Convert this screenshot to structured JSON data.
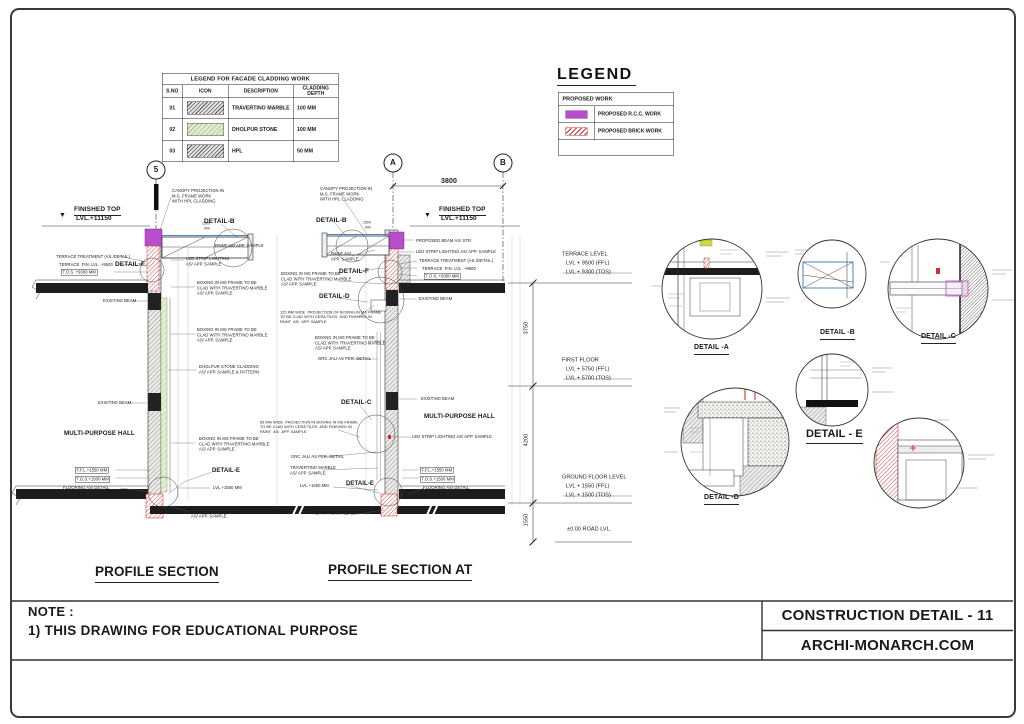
{
  "title_block": {
    "title": "CONSTRUCTION DETAIL - 11",
    "website": "ARCHI-MONARCH.COM"
  },
  "note": {
    "label": "NOTE :",
    "line1": "1) THIS DRAWING FOR EDUCATIONAL PURPOSE"
  },
  "cladding_legend": {
    "title": "LEGEND FOR FACADE CLADDING  WORK",
    "headers": [
      "S.NO",
      "ICON",
      "DESCRIPTION",
      "CLADDING DEPTH"
    ],
    "rows": [
      {
        "sno": "01",
        "icon": "travertino-hatch",
        "description": "TRAVERTINO MARBLE",
        "depth": "100 MM"
      },
      {
        "sno": "02",
        "icon": "dholpur-hatch",
        "description": "DHOLPUR STONE",
        "depth": "100 MM"
      },
      {
        "sno": "03",
        "icon": "hpl-hatch",
        "description": "HPL",
        "depth": "50 MM"
      }
    ]
  },
  "work_legend": {
    "title": "LEGEND",
    "header": "PROPOSED WORK",
    "items": [
      {
        "type": "rcc",
        "label": "PROPOSED R.C.C. WORK"
      },
      {
        "type": "brick",
        "label": "PROPOSED BRICK WORK"
      }
    ]
  },
  "colors": {
    "rcc_purple": "#b84ecb",
    "brick_red": "#cc3333",
    "canopy_blue": "#4a86c2",
    "dholpur_green": "#e1ecd1"
  },
  "annotations": [
    {
      "t": "5",
      "x": 156,
      "y": 170,
      "fs": 8,
      "ctr": 1,
      "b": 1
    },
    {
      "t": "A",
      "x": 393,
      "y": 163,
      "fs": 8,
      "ctr": 1,
      "b": 1
    },
    {
      "t": "B",
      "x": 503,
      "y": 163,
      "fs": 8,
      "ctr": 1,
      "b": 1
    },
    {
      "t": "FINISHED TOP",
      "x": 74,
      "y": 206,
      "fs": 6.5,
      "u": 1,
      "b": 1
    },
    {
      "t": "LVL.+11150",
      "x": 76,
      "y": 215,
      "fs": 6.5,
      "b": 1
    },
    {
      "t": "▼",
      "x": 59,
      "y": 212,
      "fs": 7
    },
    {
      "t": "CANOPY PROJECTION IN\nM.S. FRAME WORK\nWITH HPL CLADDING",
      "x": 172,
      "y": 188
    },
    {
      "t": "DETAIL-B",
      "x": 204,
      "y": 218,
      "fs": 6.5,
      "b": 1
    },
    {
      "t": "1500",
      "x": 202,
      "y": 222,
      "fs": 3.4
    },
    {
      "t": "900",
      "x": 204,
      "y": 227,
      "fs": 3.4
    },
    {
      "t": "PAINT AS/ APP. SAMPLE",
      "x": 215,
      "y": 243
    },
    {
      "t": "TERRACE TREATMENT (AS./DETAIL)",
      "x": 56,
      "y": 254
    },
    {
      "t": "TERRACE  FIN. LVL. +9500",
      "x": 59,
      "y": 262
    },
    {
      "t": "T.O.S. +9300 MM",
      "x": 61,
      "y": 269,
      "box": 1
    },
    {
      "t": "DETAIL-F",
      "x": 115,
      "y": 261,
      "fs": 6.5,
      "b": 1
    },
    {
      "t": "LED STRIP LIGHTING\nAS/ APP. SAMPLE",
      "x": 186,
      "y": 256
    },
    {
      "t": "EXISTING BEAM",
      "x": 103,
      "y": 298
    },
    {
      "t": "BOXING IN MS FRAME TO BE\nCLAD WITH TRAVERTINO MARBLE\nAS/ APP. SAMPLE",
      "x": 197,
      "y": 280
    },
    {
      "t": "BOXING IN MS FRAME TO BE\nCLAD WITH TRAVERTINO MARBLE\nAS/ APP. SAMPLE",
      "x": 197,
      "y": 327
    },
    {
      "t": "DHOLPUR STONE CLADDING\nAS/ APP. SAMPLE & PATTERN",
      "x": 199,
      "y": 364
    },
    {
      "t": "EXISTING BEAM",
      "x": 98,
      "y": 400
    },
    {
      "t": "MULTI-PURPOSE HALL",
      "x": 64,
      "y": 430,
      "fs": 6.2,
      "b": 1
    },
    {
      "t": "BOXING IN MS FRAME TO BE\nCLAD WITH TRAVERTINO MARBLE\nAS/ APP. SAMPLE",
      "x": 199,
      "y": 436
    },
    {
      "t": "DETAIL-E",
      "x": 212,
      "y": 468,
      "fs": 6,
      "b": 1
    },
    {
      "t": "F.F.L.+1550 MM",
      "x": 75,
      "y": 467,
      "box": 1
    },
    {
      "t": "T.O.S.+1500 MM",
      "x": 75,
      "y": 476,
      "box": 1
    },
    {
      "t": "FLOORING AS/ DETAIL",
      "x": 63,
      "y": 485
    },
    {
      "t": "LVL.+1500 MM",
      "x": 213,
      "y": 485
    },
    {
      "t": "TRAVERTINO MARBLE\nAS/ APP. SAMPLE",
      "x": 191,
      "y": 508
    },
    {
      "t": "PROFILE SECTION",
      "x": 95,
      "y": 564,
      "fs": 13.5,
      "u": 1,
      "b": 1
    },
    {
      "t": "3800",
      "x": 441,
      "y": 178,
      "fs": 7,
      "b": 1
    },
    {
      "t": "CANOPY PROJECTION IN\nM.S. FRAME WORK\nWITH HPL CLADDING",
      "x": 320,
      "y": 186
    },
    {
      "t": "DETAIL-B",
      "x": 316,
      "y": 217,
      "fs": 6.5,
      "b": 1
    },
    {
      "t": "1500",
      "x": 363,
      "y": 221,
      "fs": 3.4
    },
    {
      "t": "900",
      "x": 365,
      "y": 226,
      "fs": 3.4
    },
    {
      "t": "FINISHED TOP",
      "x": 439,
      "y": 206,
      "fs": 6.5,
      "u": 1,
      "b": 1
    },
    {
      "t": "LVL.+11150",
      "x": 441,
      "y": 215,
      "fs": 6.5,
      "b": 1
    },
    {
      "t": "▼",
      "x": 424,
      "y": 212,
      "fs": 7
    },
    {
      "t": "PROPOSED BEAM AS/ STR.",
      "x": 416,
      "y": 238
    },
    {
      "t": "LED STRIP LIGHTING AS/ APP. SAMPLE",
      "x": 416,
      "y": 249
    },
    {
      "t": "PAINT AS/\nAPP. SAMPLE",
      "x": 331,
      "y": 251
    },
    {
      "t": "TERRACE TREATMENT (AS./DETAIL)",
      "x": 419,
      "y": 258
    },
    {
      "t": "TERRACE  FIN. LVL. +9500",
      "x": 422,
      "y": 266
    },
    {
      "t": "T.O.S. +9300 MM",
      "x": 424,
      "y": 273,
      "box": 1
    },
    {
      "t": "DETAIL-F",
      "x": 339,
      "y": 268,
      "fs": 6.5,
      "b": 1
    },
    {
      "t": "BOXING IN MS FRAME TO BE\nCLAD WITH TRAVERTINO MARBLE\nAS/ APP. SAMPLE",
      "x": 281,
      "y": 271
    },
    {
      "t": "DETAIL-D",
      "x": 319,
      "y": 293,
      "fs": 6.5,
      "b": 1
    },
    {
      "t": "EXISTING BEAM",
      "x": 419,
      "y": 296
    },
    {
      "t": "125 MM WIDE  PROJECTION OF BOXING IN MS FRAME\nTO BE CLAD WITH CERA TILES  AND FINISHED IN\nPAINT  AS/  APP. SAMPLE",
      "x": 280,
      "y": 310,
      "fs": 3.8
    },
    {
      "t": "BOXING IN MS FRAME TO BE\nCLAD WITH TRAVERTINO MARBLE\nAS/ APP. SAMPLE",
      "x": 315,
      "y": 335
    },
    {
      "t": "GRC JALI AS PER  DETAIL",
      "x": 318,
      "y": 356
    },
    {
      "t": "DETAIL-C",
      "x": 341,
      "y": 399,
      "fs": 6.5,
      "b": 1
    },
    {
      "t": "EXISTING BEAM",
      "x": 421,
      "y": 396
    },
    {
      "t": "MULTI-PURPOSE HALL",
      "x": 424,
      "y": 413,
      "fs": 6.2,
      "b": 1
    },
    {
      "t": "LED STRIP LIGHTING AS/ APP. SAMPLE",
      "x": 412,
      "y": 434
    },
    {
      "t": "65 MM WIDE  PROJECTION IN BOXING IN MS FRAME\nTO BE CLAD WITH CERA TILES  AND FINISHED IN\nPAINT  AS/  APP. SAMPLE",
      "x": 260,
      "y": 420,
      "fs": 3.8
    },
    {
      "t": "GRC JALI AS PER  DETAIL",
      "x": 291,
      "y": 454
    },
    {
      "t": "TRAVERTINO MARBLE\nAS/ APP. SAMPLE",
      "x": 290,
      "y": 465
    },
    {
      "t": "DETAIL-E",
      "x": 346,
      "y": 481,
      "fs": 6,
      "b": 1
    },
    {
      "t": "LVL.+1500 MM",
      "x": 300,
      "y": 483
    },
    {
      "t": "F.F.L.+1550 MM",
      "x": 420,
      "y": 467,
      "box": 1
    },
    {
      "t": "T.O.S.+1500 MM",
      "x": 420,
      "y": 476,
      "box": 1
    },
    {
      "t": "FLOORING AS/ DETAIL",
      "x": 423,
      "y": 485
    },
    {
      "t": "TRAVERTINO MARBLE\nAS/ APP. SAMPLE",
      "x": 313,
      "y": 505
    },
    {
      "t": "PROFILE SECTION AT",
      "x": 328,
      "y": 562,
      "fs": 13.5,
      "u": 1,
      "b": 1
    },
    {
      "t": "TERRACE LEVEL",
      "x": 562,
      "y": 251,
      "fs": 5.5
    },
    {
      "t": "LVL + 9500 (FFL)",
      "x": 566,
      "y": 260,
      "fs": 5.5
    },
    {
      "t": "LVL + 9300 (TOS)",
      "x": 566,
      "y": 269,
      "fs": 5.5
    },
    {
      "t": "3750",
      "x": 527,
      "y": 328,
      "fs": 5.5,
      "rot": 1,
      "ctr": 1
    },
    {
      "t": "FIRST FLOOR",
      "x": 562,
      "y": 357,
      "fs": 5.5
    },
    {
      "t": "LVL + 5750 (FFL)",
      "x": 566,
      "y": 366,
      "fs": 5.5
    },
    {
      "t": "LVL + 5700 (TOS)",
      "x": 566,
      "y": 375,
      "fs": 5.5
    },
    {
      "t": "4200",
      "x": 527,
      "y": 440,
      "fs": 5.5,
      "rot": 1,
      "ctr": 1
    },
    {
      "t": "GROUND FLOOR LEVEL",
      "x": 562,
      "y": 474,
      "fs": 5.5
    },
    {
      "t": "LVL + 1550 (FFL)",
      "x": 566,
      "y": 483,
      "fs": 5.5
    },
    {
      "t": "LVL + 1500 (TOS)",
      "x": 566,
      "y": 492,
      "fs": 5.5
    },
    {
      "t": "1550",
      "x": 527,
      "y": 520,
      "fs": 5.5,
      "rot": 1,
      "ctr": 1
    },
    {
      "t": "±0.00 ROAD LVL.",
      "x": 567,
      "y": 526,
      "fs": 5.5
    },
    {
      "t": "DETAIL -A",
      "x": 694,
      "y": 344,
      "fs": 7,
      "u": 1,
      "b": 1
    },
    {
      "t": "DETAIL -B",
      "x": 820,
      "y": 329,
      "fs": 7,
      "u": 1,
      "b": 1
    },
    {
      "t": "DETAIL -C",
      "x": 921,
      "y": 333,
      "fs": 7,
      "u": 1,
      "b": 1
    },
    {
      "t": "DETAIL -D",
      "x": 704,
      "y": 494,
      "fs": 7,
      "u": 1,
      "b": 1
    },
    {
      "t": "DETAIL - E",
      "x": 806,
      "y": 428,
      "fs": 11,
      "u": 1,
      "b": 1
    }
  ]
}
